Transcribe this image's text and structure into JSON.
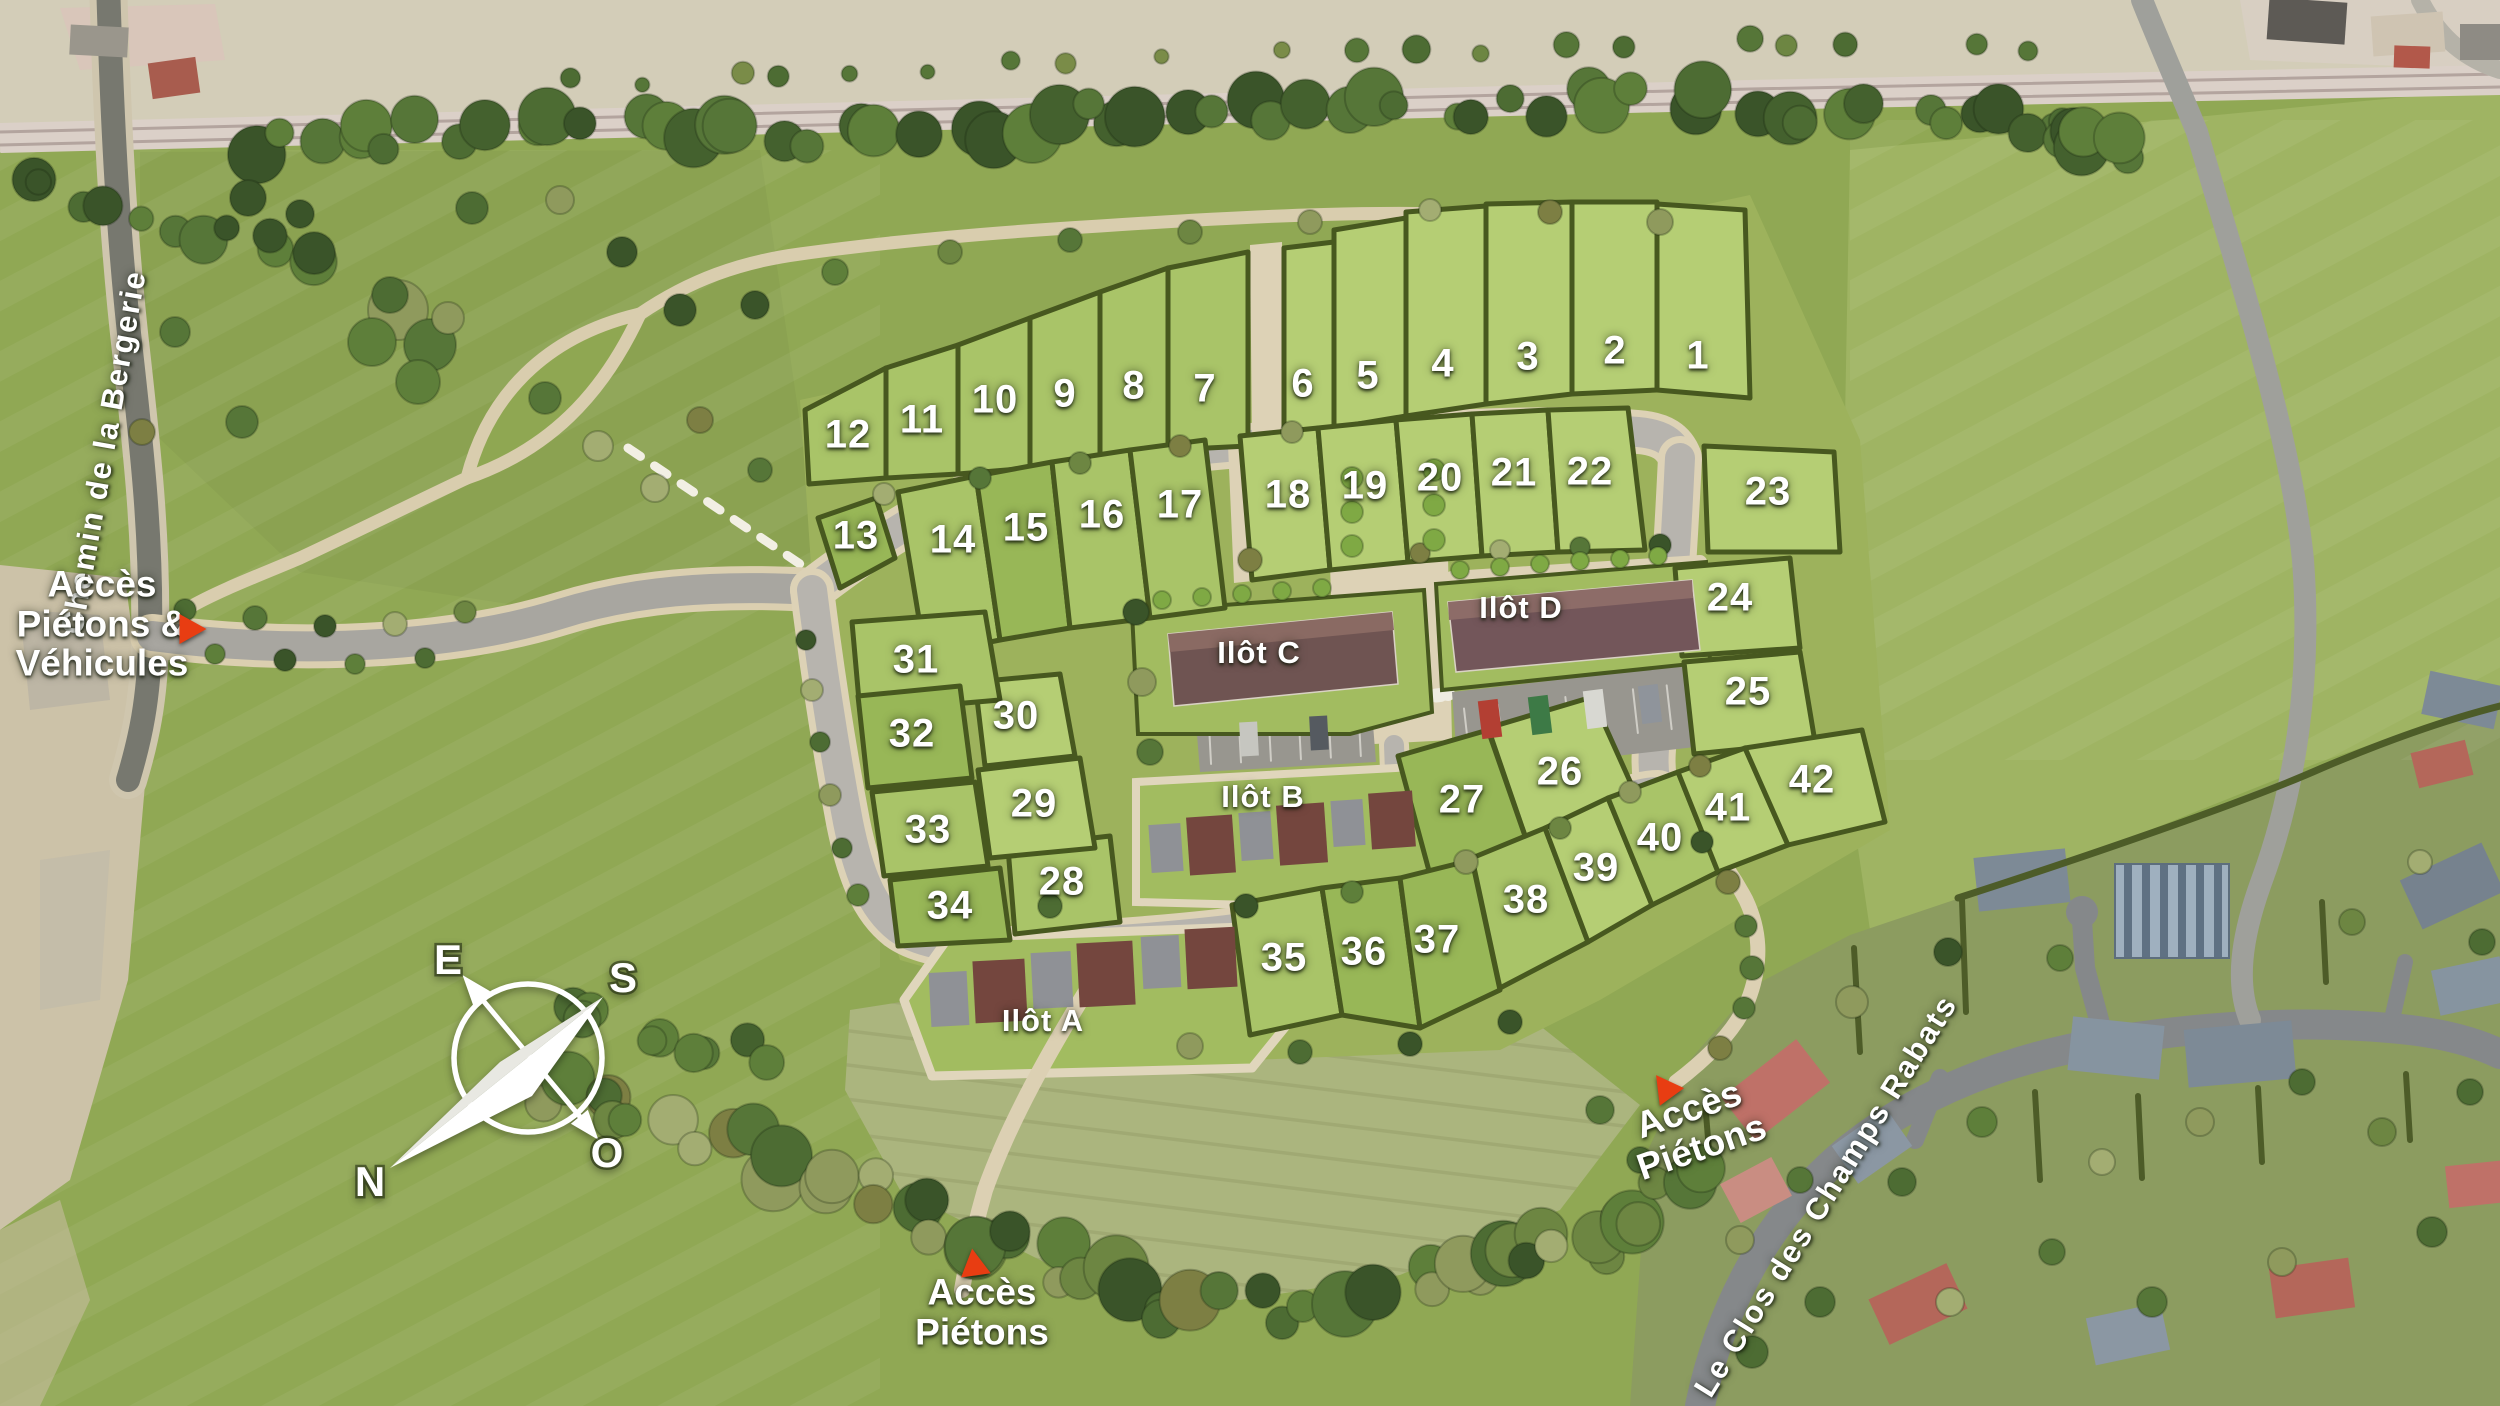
{
  "map": {
    "plots": [
      {
        "n": "1",
        "x": 1698,
        "y": 356
      },
      {
        "n": "2",
        "x": 1615,
        "y": 351
      },
      {
        "n": "3",
        "x": 1528,
        "y": 357
      },
      {
        "n": "4",
        "x": 1443,
        "y": 364
      },
      {
        "n": "5",
        "x": 1368,
        "y": 376
      },
      {
        "n": "6",
        "x": 1303,
        "y": 384
      },
      {
        "n": "7",
        "x": 1205,
        "y": 389
      },
      {
        "n": "8",
        "x": 1134,
        "y": 386
      },
      {
        "n": "9",
        "x": 1065,
        "y": 394
      },
      {
        "n": "10",
        "x": 995,
        "y": 400
      },
      {
        "n": "11",
        "x": 922,
        "y": 420
      },
      {
        "n": "12",
        "x": 848,
        "y": 435
      },
      {
        "n": "13",
        "x": 856,
        "y": 536
      },
      {
        "n": "14",
        "x": 953,
        "y": 540
      },
      {
        "n": "15",
        "x": 1026,
        "y": 528
      },
      {
        "n": "16",
        "x": 1102,
        "y": 515
      },
      {
        "n": "17",
        "x": 1180,
        "y": 505
      },
      {
        "n": "18",
        "x": 1288,
        "y": 495
      },
      {
        "n": "19",
        "x": 1365,
        "y": 486
      },
      {
        "n": "20",
        "x": 1440,
        "y": 478
      },
      {
        "n": "21",
        "x": 1514,
        "y": 473
      },
      {
        "n": "22",
        "x": 1590,
        "y": 472
      },
      {
        "n": "23",
        "x": 1768,
        "y": 492
      },
      {
        "n": "24",
        "x": 1730,
        "y": 598
      },
      {
        "n": "25",
        "x": 1748,
        "y": 692
      },
      {
        "n": "26",
        "x": 1560,
        "y": 772
      },
      {
        "n": "27",
        "x": 1462,
        "y": 800
      },
      {
        "n": "28",
        "x": 1062,
        "y": 882
      },
      {
        "n": "29",
        "x": 1034,
        "y": 804
      },
      {
        "n": "30",
        "x": 1016,
        "y": 716
      },
      {
        "n": "31",
        "x": 916,
        "y": 660
      },
      {
        "n": "32",
        "x": 912,
        "y": 734
      },
      {
        "n": "33",
        "x": 928,
        "y": 830
      },
      {
        "n": "34",
        "x": 950,
        "y": 906
      },
      {
        "n": "35",
        "x": 1284,
        "y": 958
      },
      {
        "n": "36",
        "x": 1364,
        "y": 952
      },
      {
        "n": "37",
        "x": 1437,
        "y": 940
      },
      {
        "n": "38",
        "x": 1526,
        "y": 900
      },
      {
        "n": "39",
        "x": 1596,
        "y": 868
      },
      {
        "n": "40",
        "x": 1660,
        "y": 838
      },
      {
        "n": "41",
        "x": 1728,
        "y": 808
      },
      {
        "n": "42",
        "x": 1812,
        "y": 780
      }
    ],
    "ilots": [
      {
        "label": "Ilôt A",
        "x": 1043,
        "y": 1021
      },
      {
        "label": "Ilôt B",
        "x": 1263,
        "y": 797
      },
      {
        "label": "Ilôt C",
        "x": 1259,
        "y": 653
      },
      {
        "label": "Ilôt D",
        "x": 1521,
        "y": 608
      }
    ],
    "streets": [
      {
        "label": "Chemin de la  Bergerie",
        "x": 104,
        "y": 452,
        "rotate": -80
      },
      {
        "label": "Le Clos des Champs  Rabats",
        "x": 1826,
        "y": 1196,
        "rotate": -58
      }
    ],
    "access": [
      {
        "lines": [
          "Accès",
          "Piétons &",
          "Véhicules"
        ],
        "x": 102,
        "y": 624,
        "rotate": 0,
        "arrow": {
          "x": 193,
          "y": 629,
          "dir": "right"
        }
      },
      {
        "lines": [
          "Accès",
          "Piétons"
        ],
        "x": 982,
        "y": 1312,
        "rotate": 0,
        "arrow": {
          "x": 974,
          "y": 1262,
          "dir": "up"
        }
      },
      {
        "lines": [
          "Accès",
          "Piétons"
        ],
        "x": 1695,
        "y": 1128,
        "rotate": -19,
        "arrow": {
          "x": 1664,
          "y": 1086,
          "dir": "up-left"
        }
      }
    ],
    "compass": {
      "n": "N",
      "e": "E",
      "s": "S",
      "o": "O"
    },
    "colors": {
      "arrow_red": "#e83d12",
      "label_white": "#ffffff",
      "parcel_green": "#aac468",
      "hedge_green": "#47581f"
    }
  }
}
